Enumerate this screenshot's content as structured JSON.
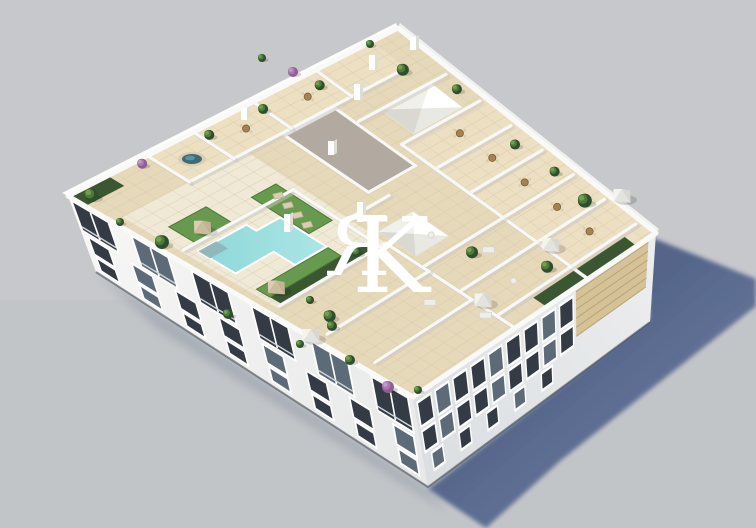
{
  "watermark": {
    "letter_1": "R",
    "letter_2": "K",
    "first_letter_mirrored": true,
    "color": "#ffffff",
    "opacity": 0.87
  },
  "palette": {
    "bg": "#c6c8cb",
    "bg_low": "#bec1c5",
    "shadow": "#4f6187",
    "shadow_far": "#6b7da1",
    "contact": "#8d96a4",
    "facade_sw": "#f6f6f5",
    "facade_sw_dark": "#e7e8e8",
    "facade_se": "#ebedee",
    "facade_se_dark": "#dcdfe2",
    "parapet": "#f9f9f7",
    "tile": "#e6d9ba",
    "tile_light": "#ecdfc2",
    "deck_light": "#efe9d6",
    "tile_line": "#d3c4a2",
    "wall_white": "#f8f8f6",
    "wall_shadow": "#c9c6c0",
    "window": "#343b45",
    "window_mid": "#5d6a77",
    "frame": "#ffffff",
    "lawn": "#679a4e",
    "lawn_dark": "#4c7a39",
    "hedge": "#3a5731",
    "pool_main": "#8ed8d8",
    "pool_light": "#abe6e6",
    "pool_deep": "#8fb3b8",
    "wood": "#a5824f",
    "wood_dark": "#7c5f38",
    "louvre": "#d5c297",
    "louvre_line": "#b9a377",
    "core": "#b2a9a1",
    "palm_dark": "#2f4f2c",
    "palm_mid": "#4e7a3a",
    "palm_light": "#72a050",
    "purple": "#8e5f96",
    "purple_light": "#a878ae",
    "white_fab": "#efeeea",
    "fab_shade": "#d8d7d1",
    "beige_fab": "#d9cdb4",
    "beige_shade": "#c2b494",
    "base_line": "#434a54"
  },
  "scene": {
    "corners": {
      "N": [
        398,
        28
      ],
      "E": [
        656,
        233
      ],
      "S": [
        413,
        397
      ],
      "W": [
        68,
        196
      ],
      "Eg": [
        650,
        322
      ],
      "Sg": [
        428,
        487
      ],
      "Wg": [
        96,
        272
      ]
    },
    "cast_shadow": [
      [
        648,
        236
      ],
      [
        756,
        279
      ],
      [
        756,
        306
      ],
      [
        560,
        461
      ],
      [
        486,
        528
      ],
      [
        428,
        489
      ],
      [
        649,
        319
      ]
    ],
    "contact_shadow": [
      [
        96,
        272
      ],
      [
        428,
        489
      ],
      [
        448,
        512
      ],
      [
        160,
        330
      ]
    ],
    "roof_patches": [
      {
        "u": [
          0.34,
          1.0
        ],
        "v": [
          0.0,
          0.28
        ],
        "fill": "tile_light"
      },
      {
        "u": [
          0.0,
          0.13
        ],
        "v": [
          0.08,
          0.76
        ],
        "fill": "tile_light"
      },
      {
        "u": [
          0.13,
          0.58
        ],
        "v": [
          0.58,
          0.97
        ],
        "fill": "deck_light"
      },
      {
        "u": [
          0.58,
          1.0
        ],
        "v": [
          0.28,
          0.97
        ],
        "fill": "tile"
      }
    ],
    "core_roof": {
      "u": [
        0.14,
        0.42
      ],
      "v": [
        0.31,
        0.47
      ]
    },
    "skylights": [
      {
        "u": [
          0.21,
          0.33
        ],
        "v": [
          0.07,
          0.23
        ]
      },
      {
        "u": [
          0.54,
          0.66
        ],
        "v": [
          0.44,
          0.56
        ]
      }
    ],
    "walls": [
      [
        0.34,
        0.02,
        0.34,
        0.28
      ],
      [
        0.46,
        0.02,
        0.46,
        0.28
      ],
      [
        0.58,
        0.02,
        0.58,
        0.28
      ],
      [
        0.7,
        0.02,
        0.7,
        0.28
      ],
      [
        0.82,
        0.02,
        0.82,
        0.28
      ],
      [
        0.94,
        0.02,
        0.94,
        0.28
      ],
      [
        0.34,
        0.28,
        1.0,
        0.28
      ],
      [
        0.21,
        0.02,
        0.21,
        0.3
      ],
      [
        0.7,
        0.28,
        0.7,
        0.58
      ],
      [
        0.82,
        0.28,
        0.82,
        0.58
      ],
      [
        0.94,
        0.28,
        0.94,
        0.58
      ],
      [
        0.58,
        0.58,
        1.0,
        0.58
      ],
      [
        0.72,
        0.58,
        0.72,
        0.96
      ],
      [
        0.86,
        0.58,
        0.86,
        0.96
      ],
      [
        0.58,
        0.58,
        0.58,
        0.96
      ],
      [
        0.3,
        0.6,
        0.3,
        0.96
      ],
      [
        0.3,
        0.6,
        0.58,
        0.6
      ],
      [
        0.13,
        0.08,
        0.13,
        0.76
      ],
      [
        0.0,
        0.25,
        0.13,
        0.25
      ],
      [
        0.0,
        0.44,
        0.13,
        0.44
      ],
      [
        0.0,
        0.62,
        0.13,
        0.62
      ],
      [
        0.0,
        0.76,
        0.13,
        0.76
      ],
      [
        0.46,
        0.44,
        0.46,
        0.58
      ]
    ],
    "pool": [
      [
        0.355,
        0.7
      ],
      [
        0.5,
        0.7
      ],
      [
        0.5,
        0.81
      ],
      [
        0.435,
        0.81
      ],
      [
        0.435,
        0.94
      ],
      [
        0.325,
        0.94
      ],
      [
        0.325,
        0.78
      ],
      [
        0.355,
        0.78
      ]
    ],
    "pool_steps": [
      [
        0.325,
        0.88
      ],
      [
        0.36,
        0.88
      ],
      [
        0.36,
        0.94
      ],
      [
        0.325,
        0.94
      ]
    ],
    "lawns": [
      {
        "u": [
          0.26,
          0.44
        ],
        "v": [
          0.615,
          0.695
        ]
      },
      {
        "u": [
          0.505,
          0.545
        ],
        "v": [
          0.7,
          0.95
        ]
      },
      {
        "u": [
          0.22,
          0.3
        ],
        "v": [
          0.8,
          0.92
        ]
      }
    ],
    "hedges": [
      {
        "u": [
          0.545,
          0.575
        ],
        "v": [
          0.62,
          0.95
        ]
      },
      {
        "u": [
          0.0,
          0.05
        ],
        "v": [
          0.88,
          1.0
        ]
      },
      {
        "u": [
          0.955,
          1.0
        ],
        "v": [
          0.08,
          0.45
        ]
      }
    ],
    "trees_uv": [
      [
        0.03,
        0.96,
        7
      ],
      [
        0.03,
        0.6,
        5
      ],
      [
        0.035,
        0.44,
        5
      ],
      [
        0.05,
        0.28,
        5
      ],
      [
        0.13,
        0.09,
        6
      ],
      [
        0.27,
        0.035,
        5
      ],
      [
        0.52,
        0.06,
        5
      ],
      [
        0.66,
        0.05,
        5
      ],
      [
        0.79,
        0.065,
        7
      ],
      [
        0.9,
        0.33,
        6
      ],
      [
        0.74,
        0.44,
        6
      ],
      [
        0.56,
        0.66,
        5
      ],
      [
        0.68,
        0.9,
        6
      ],
      [
        0.25,
        0.975,
        7
      ]
    ],
    "trees_purple_uv": [
      [
        0.015,
        0.79,
        5
      ]
    ],
    "trees_xy": [
      [
        262,
        58,
        4
      ],
      [
        370,
        44,
        4
      ],
      [
        120,
        222,
        4
      ],
      [
        228,
        314,
        5
      ],
      [
        310,
        300,
        4
      ],
      [
        332,
        326,
        5
      ],
      [
        350,
        360,
        5
      ],
      [
        418,
        390,
        4
      ],
      [
        300,
        344,
        4
      ]
    ],
    "trees_purple_xy": [
      [
        293,
        72,
        5
      ],
      [
        388,
        387,
        6
      ]
    ],
    "umbrellas": [
      {
        "uv": [
          0.27,
          0.865
        ],
        "c": "beige"
      },
      {
        "uv": [
          0.53,
          0.91
        ],
        "c": "beige"
      },
      {
        "uv": [
          0.85,
          0.26
        ],
        "c": "white"
      },
      {
        "uv": [
          0.88,
          0.56
        ],
        "c": "white"
      },
      {
        "xy": [
          622,
          196
        ],
        "c": "white"
      },
      {
        "xy": [
          311,
          336
        ],
        "c": "white"
      }
    ],
    "loungers_uv": [
      [
        0.295,
        0.645
      ],
      [
        0.335,
        0.655
      ],
      [
        0.375,
        0.665
      ],
      [
        0.415,
        0.675
      ]
    ],
    "tables_uv": [
      [
        0.4,
        0.14
      ],
      [
        0.52,
        0.14
      ],
      [
        0.64,
        0.14
      ],
      [
        0.76,
        0.14
      ],
      [
        0.88,
        0.14
      ],
      [
        0.065,
        0.33
      ],
      [
        0.065,
        0.52
      ]
    ],
    "sofas_uv": [
      [
        0.76,
        0.4
      ],
      [
        0.8,
        0.67
      ],
      [
        0.92,
        0.6
      ]
    ],
    "round_tables_uv": [
      [
        0.88,
        0.44
      ],
      [
        0.63,
        0.47
      ]
    ],
    "jacuzzi_xy": [
      192,
      159
    ],
    "pillars_xy": [
      [
        372,
        70,
        15
      ],
      [
        413,
        50,
        13
      ],
      [
        357,
        100,
        16
      ],
      [
        287,
        232,
        18
      ],
      [
        360,
        222,
        20
      ],
      [
        331,
        155,
        14
      ],
      [
        244,
        120,
        12
      ]
    ],
    "louvre_se": {
      "s": [
        0.03,
        0.33
      ],
      "h": [
        0.05,
        0.55
      ]
    },
    "facade_sw_rows": [
      {
        "n": 6,
        "w": 0.1,
        "h0": 0.06,
        "h1": 0.42,
        "s0": 0.06,
        "s1": 0.93,
        "type": "balcony"
      },
      {
        "n": 8,
        "w": 0.055,
        "h0": 0.5,
        "h1": 0.7,
        "s0": 0.05,
        "s1": 0.95
      },
      {
        "n": 8,
        "w": 0.05,
        "h0": 0.77,
        "h1": 0.91,
        "s0": 0.05,
        "s1": 0.95
      }
    ],
    "facade_se_rows": [
      {
        "n": 9,
        "w": 0.05,
        "h0": 0.1,
        "h1": 0.34,
        "s0": 0.37,
        "s1": 0.96
      },
      {
        "n": 9,
        "w": 0.05,
        "h0": 0.42,
        "h1": 0.62,
        "s0": 0.37,
        "s1": 0.96
      },
      {
        "n": 5,
        "w": 0.042,
        "h0": 0.7,
        "h1": 0.86,
        "s0": 0.46,
        "s1": 0.94
      }
    ]
  }
}
